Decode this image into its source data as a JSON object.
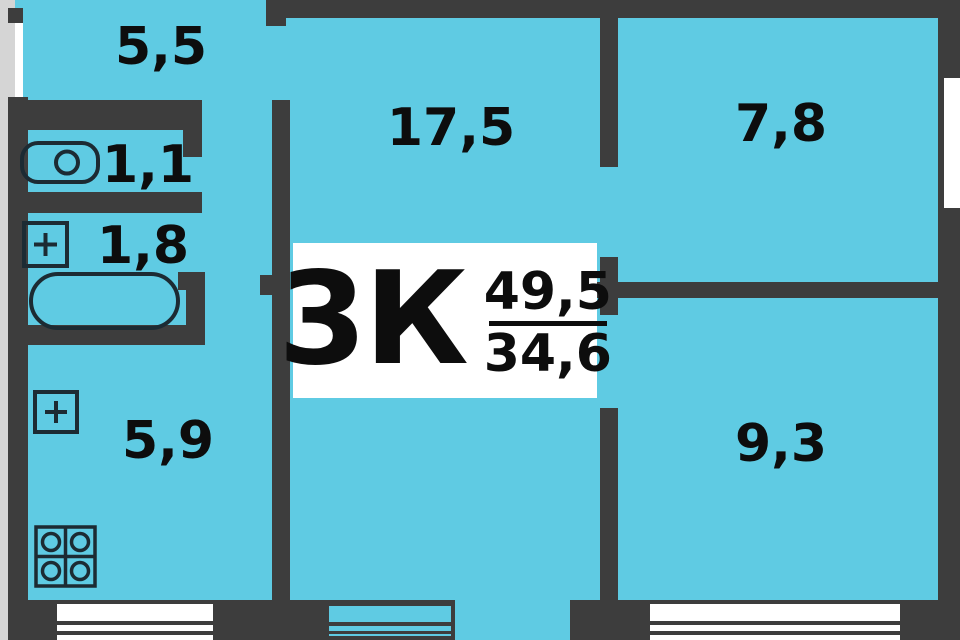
{
  "legend": {
    "type": "3К",
    "total_area": "49,5",
    "living_area": "34,6"
  },
  "rooms": {
    "hallway": {
      "area": "5,5"
    },
    "toilet": {
      "area": "1,1"
    },
    "bathroom": {
      "area": "1,8"
    },
    "kitchen": {
      "area": "5,9"
    },
    "living_room": {
      "area": "17,5"
    },
    "bedroom_small": {
      "area": "7,8"
    },
    "bedroom": {
      "area": "9,3"
    }
  },
  "colors": {
    "floor": "#5fcbe3",
    "wall": "#3d3d3d",
    "outside": "#d5d5d5",
    "window": "#ffffff",
    "label_background": "#ffffff",
    "text": "#0d0d0d"
  },
  "icons": [
    "toilet-icon",
    "sink-icon",
    "bathtub-icon",
    "kitchen-sink-icon",
    "stove-icon"
  ]
}
